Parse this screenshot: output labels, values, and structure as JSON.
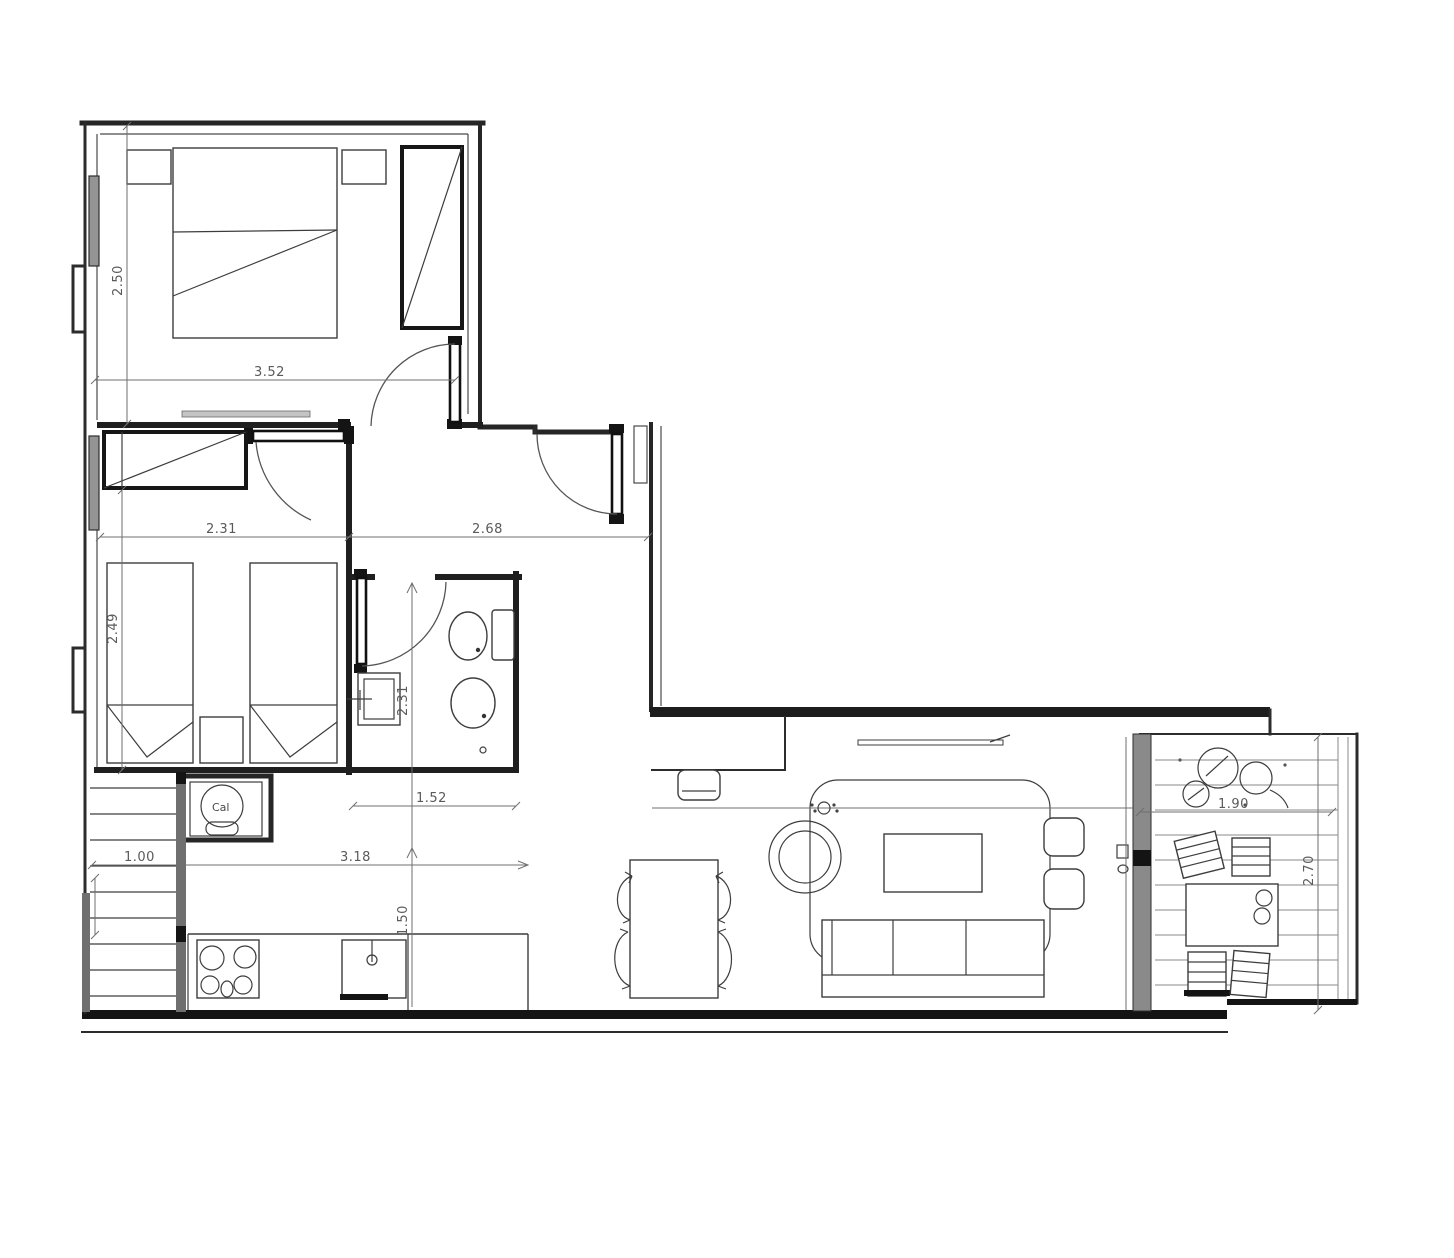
{
  "drawing": {
    "kind": "apartment floor plan sketch",
    "dims": {
      "bedroom1_width": "3.52",
      "bedroom1_depth": "2.50",
      "bedroom2_width": "2.31",
      "bedroom2_depth": "2.49",
      "hall_width": "2.68",
      "bathroom_depth": "2.31",
      "bathroom_width": "1.52",
      "stairs_width": "1.00",
      "kitchen_width": "3.18",
      "kitchen_depth": "1.50",
      "terrace_width": "1.90",
      "terrace_depth": "2.70"
    },
    "labels": {
      "boiler": "Cal"
    },
    "colors": {
      "paper": "#ffffff",
      "wall": "#1f1f1f",
      "furniture_line": "#3d3d3d",
      "dimension_line": "#6f6f6f",
      "window_fill": "#949494"
    }
  }
}
